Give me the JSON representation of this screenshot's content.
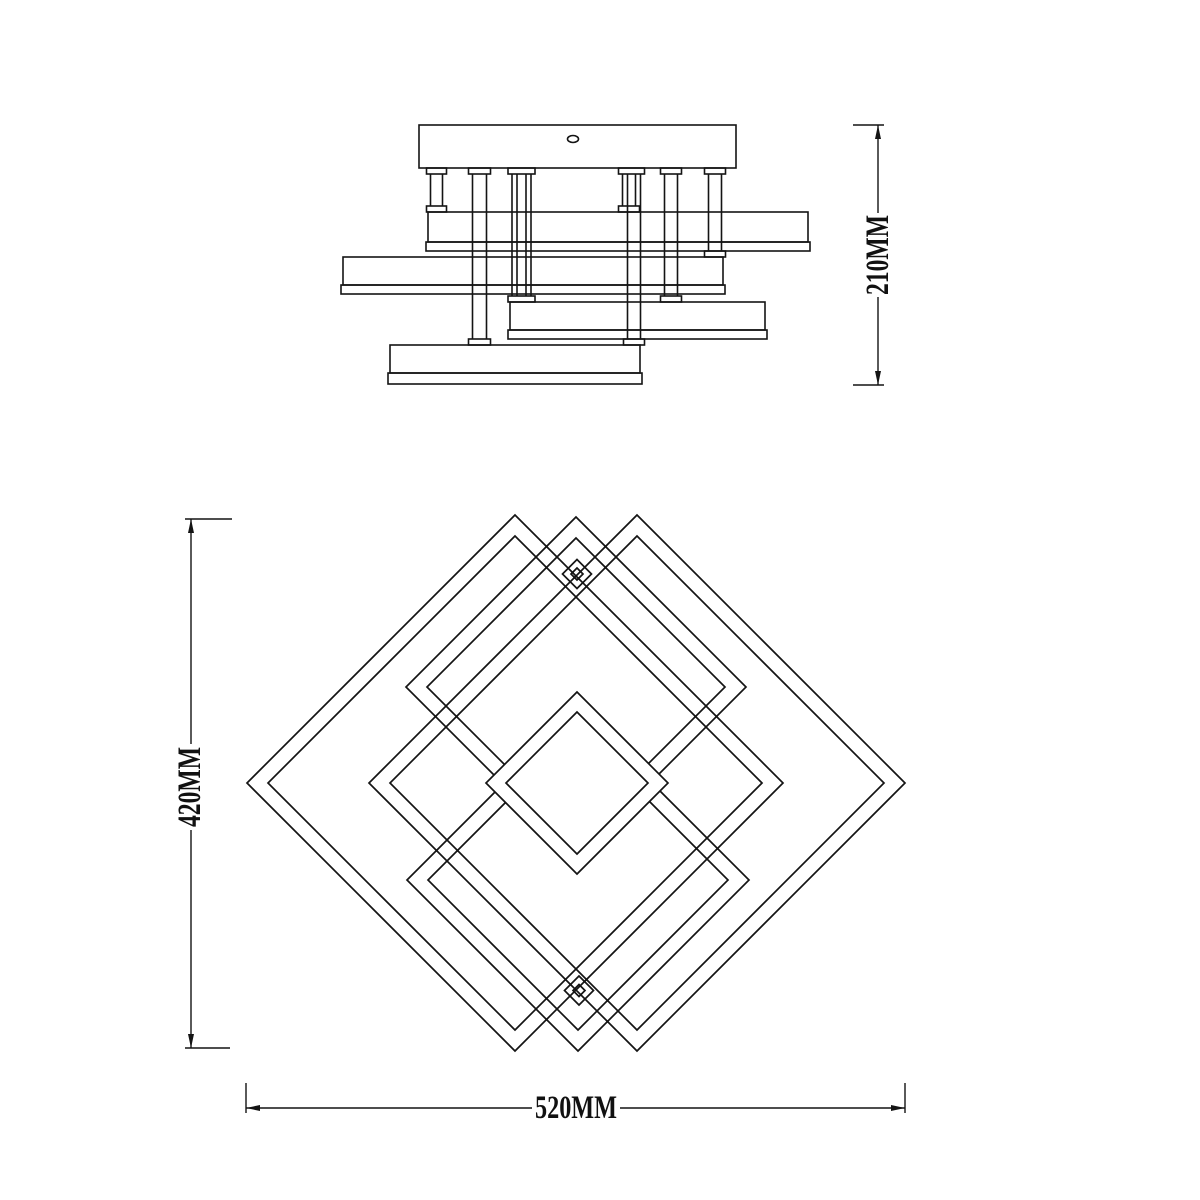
{
  "page": {
    "background": "#ffffff",
    "line_color": "#141414"
  },
  "drawing": {
    "kind": "technical dimension line drawing",
    "subject": "geometric ceiling lamp: side elevation with canopy, support rods and stacked light bars; plan view of overlapping diamond frames",
    "views": {
      "side_view": "top drawing: mounting canopy with 7 suspension rods and 4 stacked rectangular light bars",
      "plan_view": "bottom drawing: two large, two medium, one small and two tiny overlapping diamond frames"
    }
  },
  "dimensions": {
    "side_height": "210MM",
    "plan_height": "420MM",
    "plan_width": "520MM"
  }
}
